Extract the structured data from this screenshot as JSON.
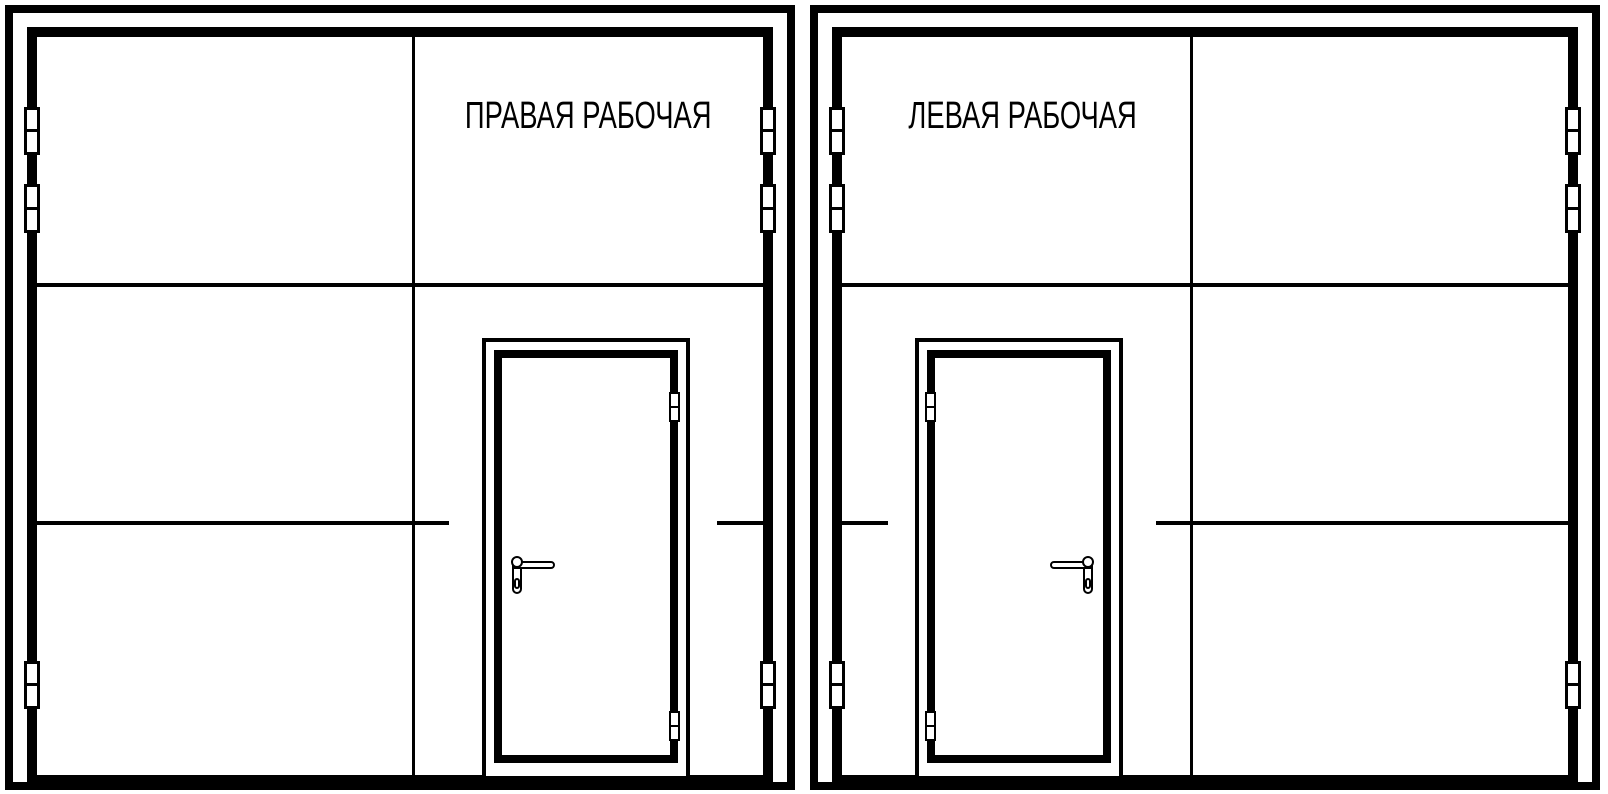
{
  "page": {
    "background_color": "#ffffff",
    "line_color": "#000000"
  },
  "panels": [
    {
      "id": "right-working",
      "label": "ПРАВАЯ РАБОЧАЯ",
      "label_position": "upper-right-leaf",
      "wicket_door_side": "right-of-center",
      "wicket_hinge_side": "right",
      "wicket_handle_side": "left",
      "gate_hinges_left": 3,
      "gate_hinges_right": 3,
      "wicket_hinges": 2
    },
    {
      "id": "left-working",
      "label": "ЛЕВАЯ РАБОЧАЯ",
      "label_position": "upper-left-leaf",
      "wicket_door_side": "left-of-center",
      "wicket_hinge_side": "left",
      "wicket_handle_side": "right",
      "gate_hinges_left": 3,
      "gate_hinges_right": 3,
      "wicket_hinges": 2
    }
  ]
}
